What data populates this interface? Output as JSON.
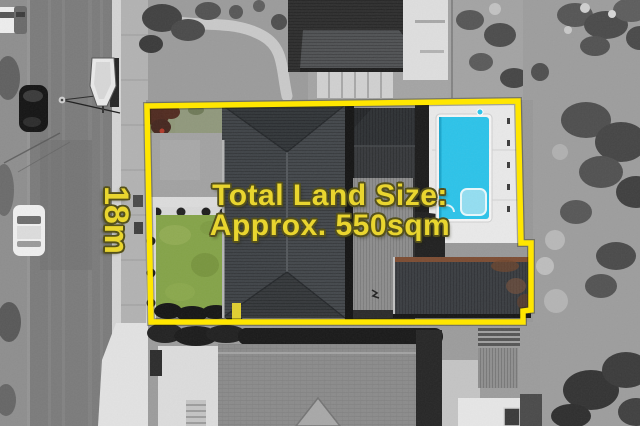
{
  "annotations": {
    "land_size": {
      "line1": "Total Land Size:",
      "line2": "Approx. 550sqm"
    },
    "frontage": {
      "label": "18m"
    }
  },
  "colors": {
    "boundary": "#ffe600",
    "label_fill": "#e9d52f",
    "label_outline": "#55511c",
    "pool_water": "#2cc3e9",
    "pool_steps": "#93def1",
    "lawn": "#84a348",
    "garage_rust": "#7c4c32",
    "shrub_red": "#4f2a20"
  }
}
